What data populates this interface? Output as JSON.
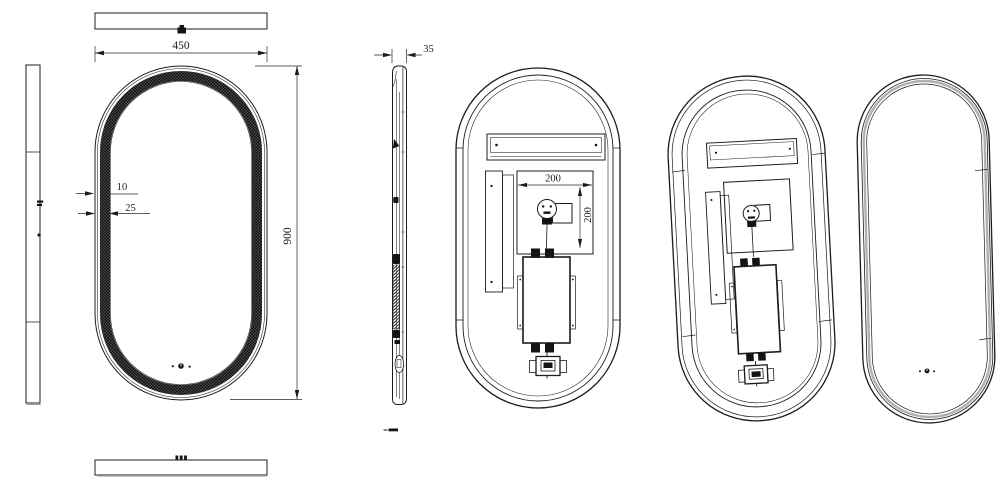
{
  "views": {
    "front": {
      "width": "450",
      "height": "900",
      "edge": "10",
      "band": "25"
    },
    "side": {
      "depth": "35"
    },
    "back": {
      "mount_width": "200",
      "mount_height": "200"
    }
  },
  "colors": {
    "line": "#1c1c1c",
    "background": "#ffffff",
    "led_band": "#181818"
  }
}
